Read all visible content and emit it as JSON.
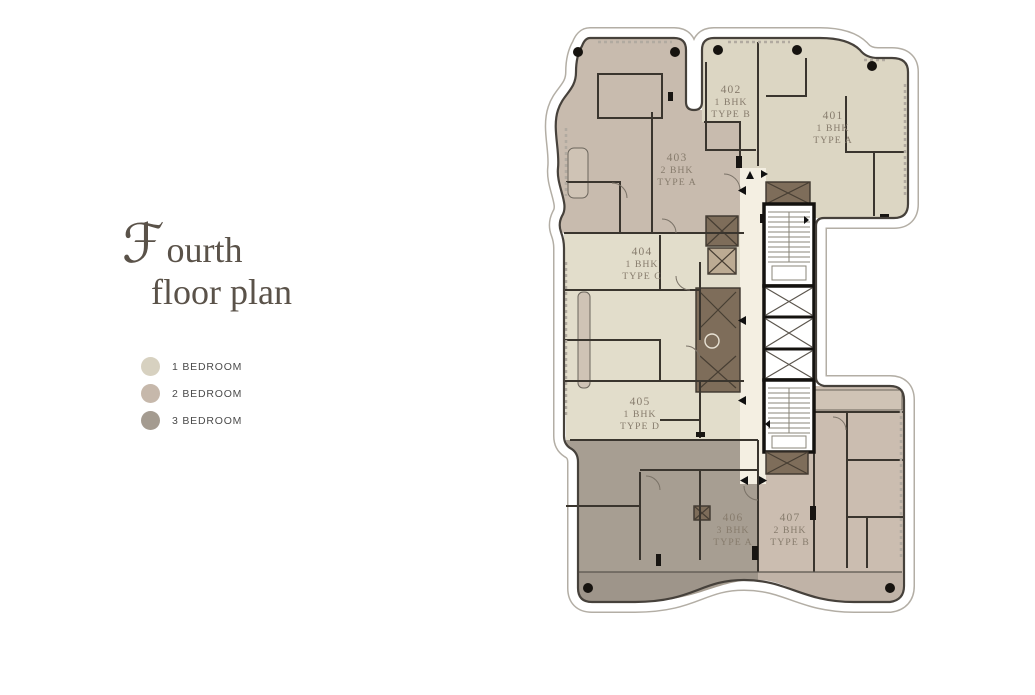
{
  "title": {
    "initial": "ℱ",
    "line1_rest": "ourth",
    "line2": "floor plan"
  },
  "legend": {
    "items": [
      {
        "label": "1 BEDROOM",
        "color": "#d7d1c0"
      },
      {
        "label": "2 BEDROOM",
        "color": "#c6b8ab"
      },
      {
        "label": "3 BEDROOM",
        "color": "#a49b90"
      }
    ]
  },
  "plan": {
    "units": [
      {
        "number": "401",
        "bhk": "1 BHK",
        "type": "TYPE A"
      },
      {
        "number": "402",
        "bhk": "1 BHK",
        "type": "TYPE B"
      },
      {
        "number": "403",
        "bhk": "2 BHK",
        "type": "TYPE A"
      },
      {
        "number": "404",
        "bhk": "1 BHK",
        "type": "TYPE C"
      },
      {
        "number": "405",
        "bhk": "1 BHK",
        "type": "TYPE D"
      },
      {
        "number": "406",
        "bhk": "3 BHK",
        "type": "TYPE A"
      },
      {
        "number": "407",
        "bhk": "2 BHK",
        "type": "TYPE B"
      }
    ],
    "colors": {
      "bhk1_light": "#dcd6c3",
      "bhk1_lighter": "#e2ddcb",
      "bhk2": "#c8bbae",
      "bhk2_light": "#cbbdb0",
      "bhk3": "#a79e92",
      "corridor": "#f4efe2",
      "core_brown": "#7e6d5a",
      "core_tan": "#bcab93",
      "balcony_tan": "#cfc3b5",
      "wall": "#3a352e",
      "outline": "#46413b",
      "outer_ring": "#b3aea5",
      "column_dot": "#16130f",
      "unit_label": "#877c6d"
    }
  }
}
